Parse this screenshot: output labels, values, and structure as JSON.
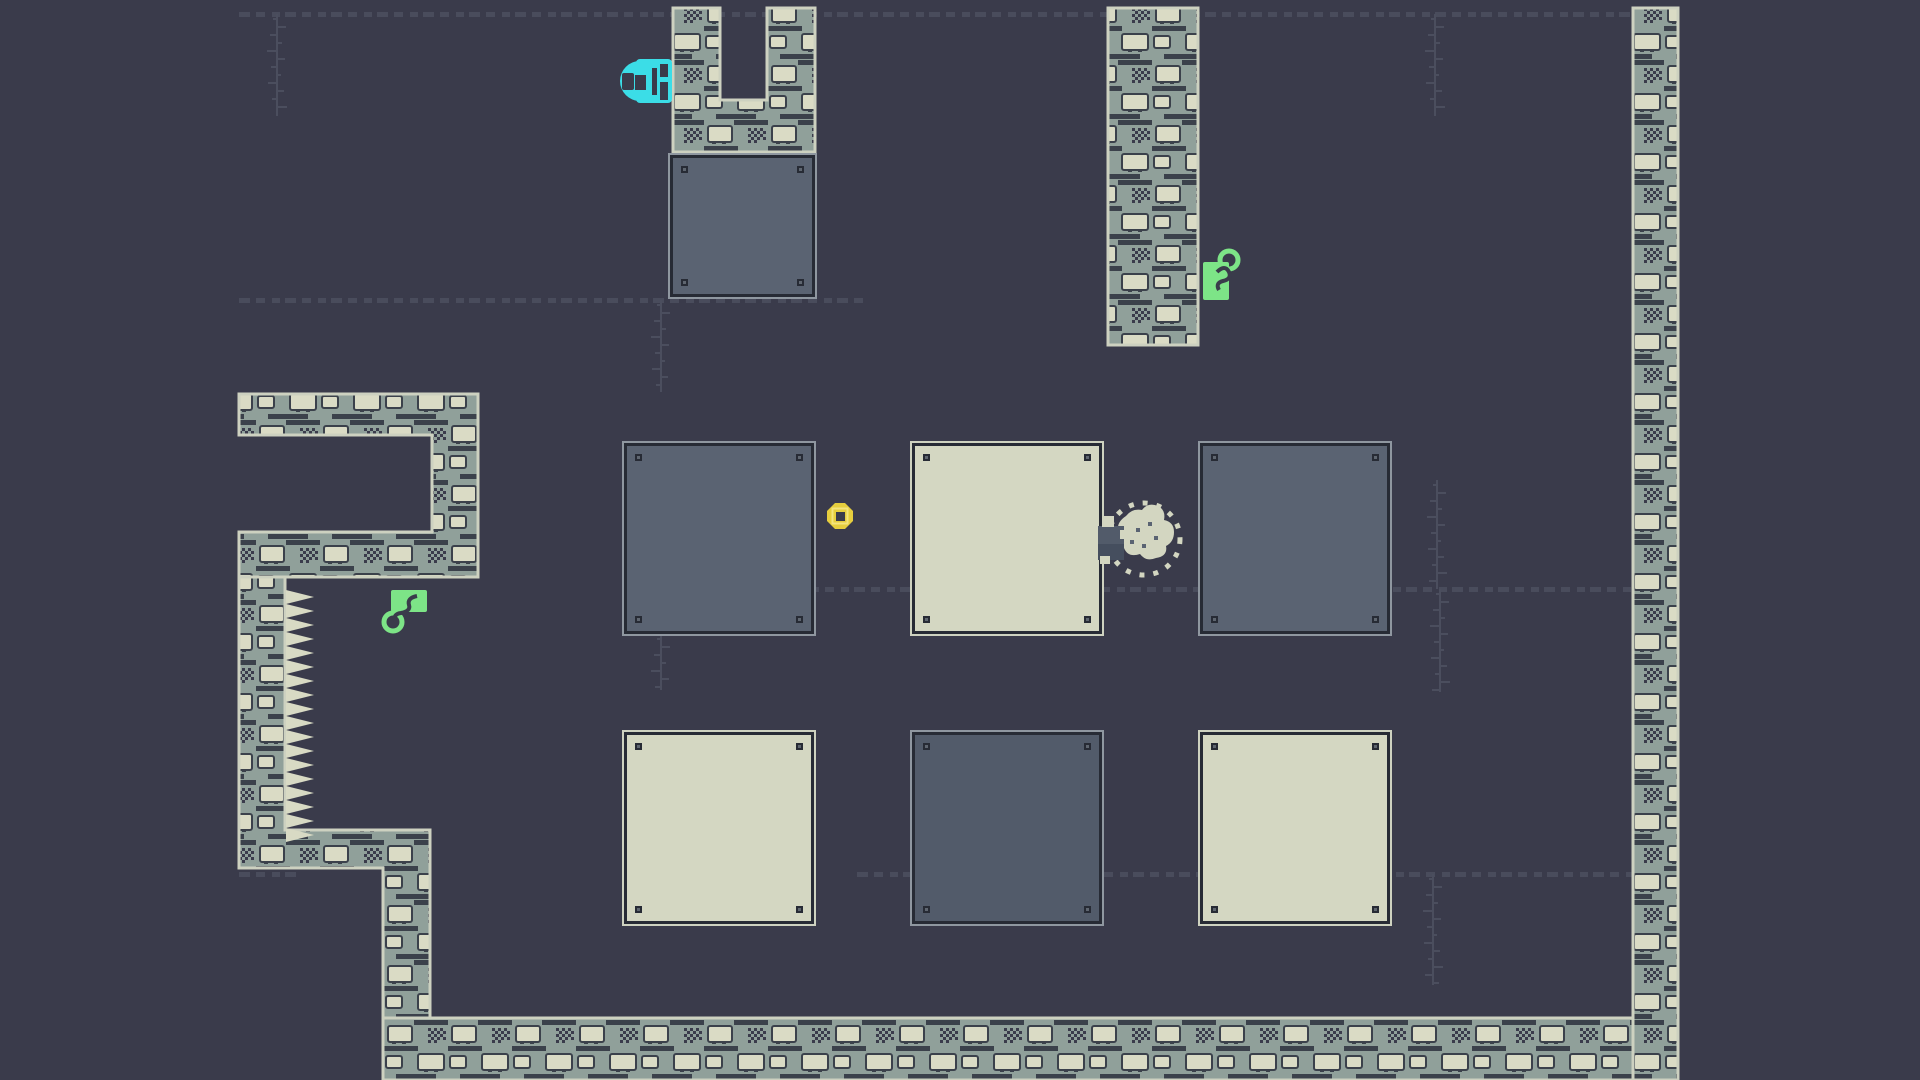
{
  "scene": {
    "title": "pixel-puzzle-level"
  },
  "palette": {
    "background": "#3a3b4b",
    "dash": "#4b4e5e",
    "wall_base": "#90a09a",
    "wall_stone": "#dadbc5",
    "wall_seam": "#3b414b",
    "wall_edge": "#cdd1c0",
    "spike": "#d8dac4",
    "block_dark": "#5a6372",
    "block_dark_alt": "#525b6a",
    "block_cream": "#d4d7c2",
    "block_border": "#272b35",
    "edge_dark_block": "#8f97a0",
    "edge_cream_block": "#ced2c0",
    "lock_cyan": "#3bdde7",
    "key_green": "#7de487",
    "coin_yellow": "#e6ce3e",
    "coin_highlight": "#f4e47c",
    "player_gray": "#525b6a",
    "player_gray_dark": "#454e5e",
    "blob_cream": "#d3d6c1"
  },
  "structures": {
    "u_shape_d": "M673,8 H720 V100 H767 V8 H815 V152 H673 Z",
    "right_column_d": "M1108,8 H1198 V345 H1108 Z",
    "right_wall_d": "M1633,8 H1678 V1080 H1633 Z",
    "bottom_wall_d": "M383,1018 H1633 V1080 H383 Z",
    "left_bracket_d": "M239,394 H478 V577 H239 V532 H432 V435 H239 Z",
    "left_wall_stair_d": "M239,577 H285 V830 H430 V1018 H383 V868 H239 Z",
    "spikes_points": "286,590 314,597 286,604 314,611 286,618 314,625 286,632 314,639 286,646 314,653 286,660 314,667 286,674 314,681 286,688 314,695 286,702 314,709 286,716 314,723 286,730 314,737 286,744 314,751 286,758 314,765 286,772 314,779 286,786 314,793 286,800 314,807 286,814 314,821 286,828 314,835 286,842"
  },
  "blocks": [
    {
      "name": "block-top-dark",
      "variant": "dark",
      "style": "left:670px;top:155px;width:145px;height:142px"
    },
    {
      "name": "block-row1-dark-1",
      "variant": "dark",
      "style": "left:624px;top:443px;width:190px;height:191px"
    },
    {
      "name": "block-row1-cream",
      "variant": "cream",
      "style": "left:912px;top:443px;width:190px;height:191px"
    },
    {
      "name": "block-row1-dark-2",
      "variant": "dark",
      "style": "left:1200px;top:443px;width:190px;height:191px"
    },
    {
      "name": "block-row2-cream-1",
      "variant": "cream",
      "style": "left:624px;top:732px;width:190px;height:192px"
    },
    {
      "name": "block-row2-dark",
      "variant": "dark2",
      "style": "left:912px;top:732px;width:190px;height:192px"
    },
    {
      "name": "block-row2-cream-2",
      "variant": "cream",
      "style": "left:1200px;top:732px;width:190px;height:192px"
    }
  ],
  "items": {
    "lock": {
      "transform": "translate(620,59)"
    },
    "key_right": {
      "transform": "translate(1203,248)"
    },
    "key_left": {
      "transform": "translate(383,590)"
    },
    "coin": {
      "transform": "translate(827,503)"
    },
    "player": {
      "transform": "translate(1096,500)"
    }
  },
  "decorations": {
    "dashed_lines": [
      {
        "x1": 239,
        "y": 14,
        "x2": 1633
      },
      {
        "x1": 239,
        "y": 300,
        "x2": 869
      },
      {
        "x1": 624,
        "y": 589,
        "x2": 1633
      },
      {
        "x1": 239,
        "y": 874,
        "x2": 302
      },
      {
        "x1": 857,
        "y": 874,
        "x2": 1633
      }
    ],
    "vines": [
      {
        "x": 277,
        "y1": 14,
        "y2": 116
      },
      {
        "x": 1435,
        "y1": 14,
        "y2": 116
      },
      {
        "x": 661,
        "y1": 300,
        "y2": 392
      },
      {
        "x": 661,
        "y1": 634,
        "y2": 690
      },
      {
        "x": 1437,
        "y1": 480,
        "y2": 589
      },
      {
        "x": 1440,
        "y1": 589,
        "y2": 692
      },
      {
        "x": 1433,
        "y1": 874,
        "y2": 985
      }
    ]
  }
}
